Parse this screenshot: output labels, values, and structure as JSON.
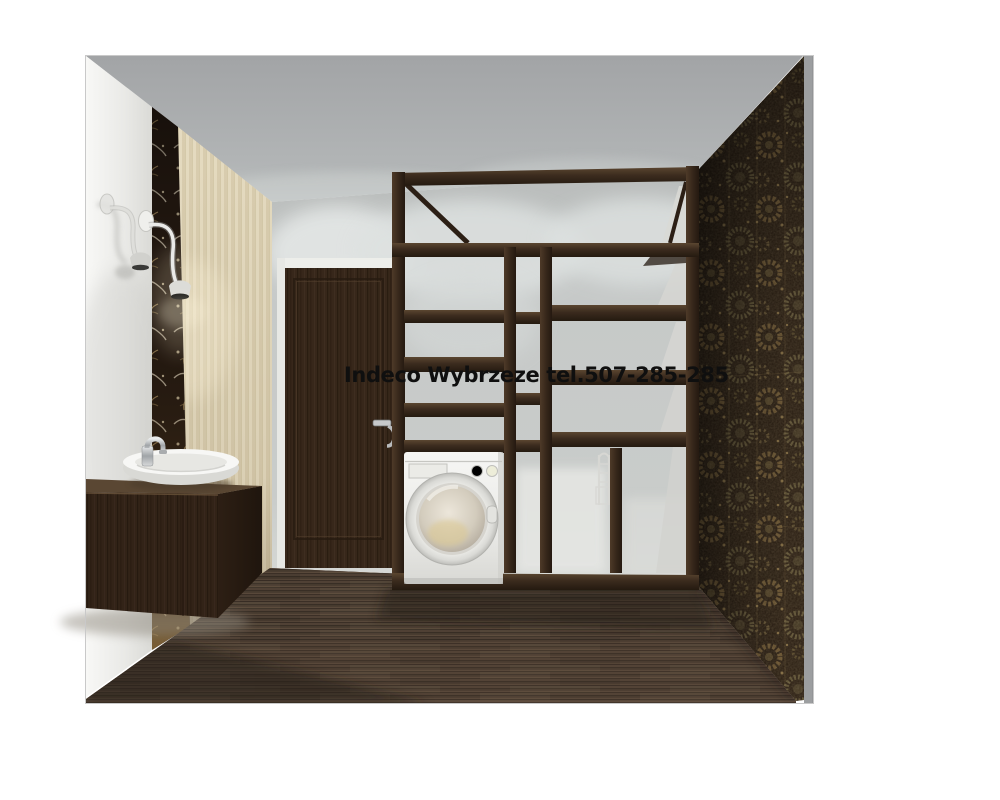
{
  "watermark": {
    "text": "Indeco Wybrzeze tel.507-285-285"
  },
  "palette": {
    "page_bg": "#ffffff",
    "watermark_text_color": "#0f0f0f",
    "ceiling": "#a9abad",
    "left_wall_white": "#f2f2f0",
    "beige_wallpaper": "#e2d7bb",
    "decor_strip_dark": "#241911",
    "decor_strip_gold": "#b3945c",
    "back_wall": "#c5c8c7",
    "door_wood": "#3c2b1d",
    "door_casing": "#edeeea",
    "furniture_wood": "#3a2a1d",
    "floor_wood": "#4c3c2f",
    "floral_wallpaper_base": "#281c11",
    "floral_wallpaper_gold": "#a98a52",
    "washer_body": "#f1f1ef",
    "chrome": "#c3c6c8",
    "wall_edge_strip": "#9c9ea0"
  },
  "scene": {
    "type": "3d-interior-render",
    "objects": [
      "ceiling",
      "left-wall",
      "decor-strip",
      "striped-wallpaper-wall",
      "wall-lamp-left",
      "wall-lamp-right",
      "vanity-cabinet",
      "vessel-sink",
      "faucet",
      "interior-door",
      "door-handle",
      "back-wall",
      "wardrobe-shelving-unit",
      "washing-machine",
      "pull-out-rack",
      "floral-wallpaper-wall",
      "wood-floor",
      "wall-edge-strip"
    ]
  }
}
